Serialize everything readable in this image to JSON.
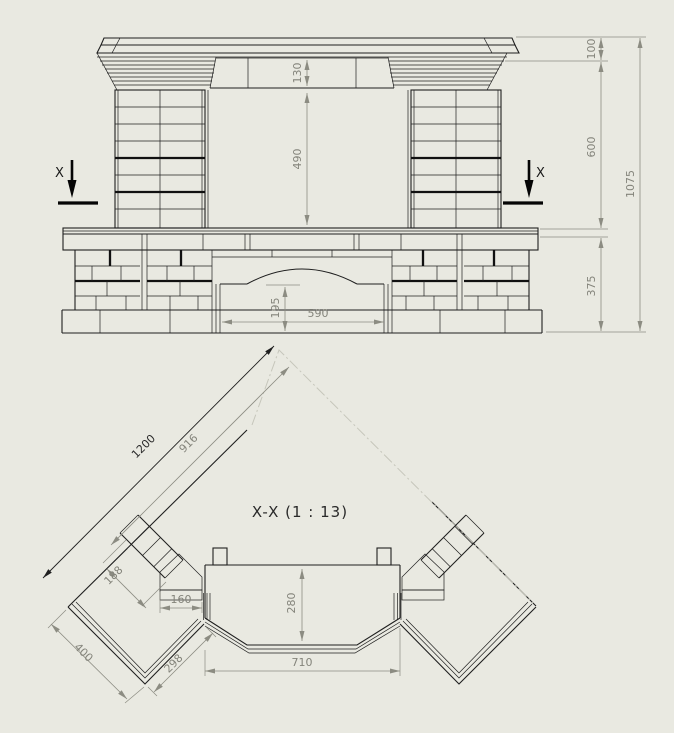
{
  "background": "#e9e9e1",
  "line_color": "#1f1f1f",
  "dim_color": "#84847b",
  "front_view": {
    "section_marker_label": "X",
    "dims": {
      "frieze_height": "130",
      "opening_height": "490",
      "base_opening_height": "195",
      "base_opening_width": "590",
      "cornice_height": "100",
      "upper_height": "600",
      "base_height": "375",
      "total_height": "1075"
    }
  },
  "section_view": {
    "title": "X-X (1 : 13)",
    "dims": {
      "overall_diagonal": "1200",
      "inner_diagonal": "916",
      "wing_width": "188",
      "jamb_width": "160",
      "firebox_depth": "280",
      "firebox_width": "710",
      "hearth_left_edge": "400",
      "hearth_right_edge": "298"
    }
  }
}
